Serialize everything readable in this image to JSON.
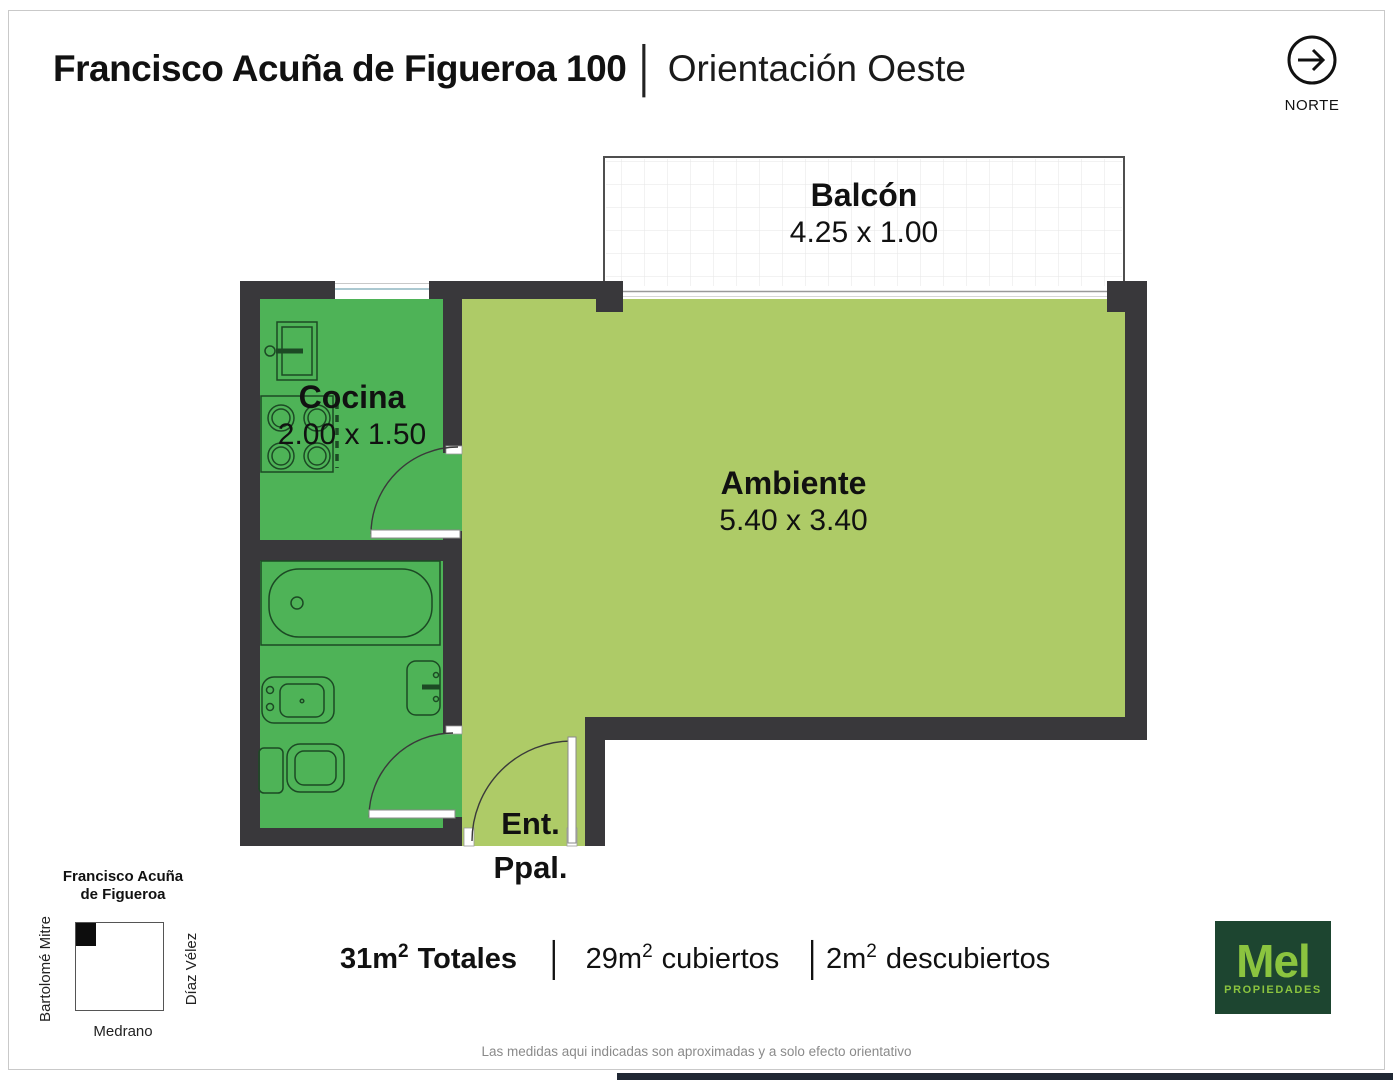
{
  "header": {
    "address": "Francisco Acuña de Figueroa 100",
    "separator": "│",
    "orientation": "Orientación Oeste"
  },
  "north": {
    "label": "NORTE"
  },
  "rooms": {
    "balcony": {
      "name": "Balcón",
      "dims": "4.25 x 1.00"
    },
    "kitchen": {
      "name": "Cocina",
      "dims": "2.00 x 1.50"
    },
    "main": {
      "name": "Ambiente",
      "dims": "5.40 x 3.40"
    },
    "entrance": {
      "line1": "Ent.",
      "line2": "Ppal."
    }
  },
  "areas": {
    "separator": "│",
    "total": {
      "value": "31m",
      "sup": "2",
      "label": "Totales"
    },
    "covered": {
      "value": "29m",
      "sup": "2",
      "label": "cubiertos"
    },
    "uncovered": {
      "value": "2m",
      "sup": "2",
      "label": "descubiertos"
    }
  },
  "minimap": {
    "title_line1": "Francisco Acuña",
    "title_line2": "de Figueroa",
    "street_left": "Bartolomé Mitre",
    "street_right": "Díaz Vélez",
    "street_bottom": "Medrano"
  },
  "logo": {
    "name": "Mel",
    "subtitle": "PROPIEDADES"
  },
  "disclaimer": "Las medidas aqui indicadas son aproximadas y a solo efecto orientativo",
  "colors": {
    "wall": "#39383b",
    "room_green": "#4eb357",
    "room_light_green": "#aecb67",
    "balcony_border": "#4f4f4f",
    "logo_bg": "#1d4530",
    "logo_green": "#8bc43f"
  }
}
